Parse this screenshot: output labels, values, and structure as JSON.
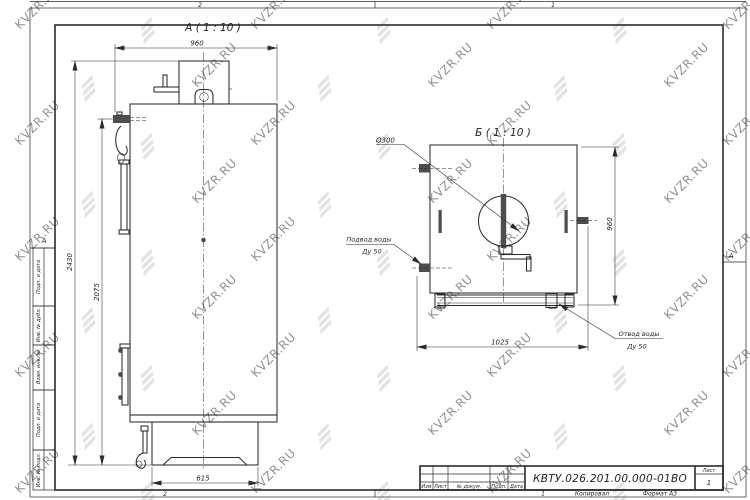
{
  "watermark": {
    "text": "KVZR.RU"
  },
  "colors": {
    "line": "#2b2b2b",
    "watermark": "#c4c9c7",
    "background": "#ffffff"
  },
  "frame": {
    "zones": {
      "top_left": "2",
      "top_right": "1",
      "bottom_left": "2",
      "bottom_right_num": "1",
      "side_left": "А",
      "side_right": "А"
    },
    "stamp_column": [
      "Подп. и дата",
      "Инв. № дубл.",
      "Взам. инв. №",
      "Подп. и дата",
      "Инв. № подл."
    ]
  },
  "title_block": {
    "doc_number": "КВТУ.026.201.00.000-01ВО",
    "headers": [
      "Изм",
      "Лист",
      "№ докум.",
      "Подп.",
      "Дата"
    ],
    "sheet_label": "Лист",
    "sheet_value": "1",
    "kopiroval": "Копировал",
    "format": "Формат А3"
  },
  "view_a": {
    "label": "А ( 1 : 10 )",
    "dims": {
      "width_top": "960",
      "height_total": "2430",
      "height_door": "2075",
      "base_width": "615"
    }
  },
  "view_b": {
    "label": "Б ( 1 : 10 )",
    "dims": {
      "diameter": "Ø300",
      "height": "960",
      "width": "1025"
    },
    "inlet": {
      "line1": "Подвод воды",
      "line2": "Ду 50"
    },
    "outlet": {
      "line1": "Отвод воды",
      "line2": "Ду 50"
    }
  }
}
